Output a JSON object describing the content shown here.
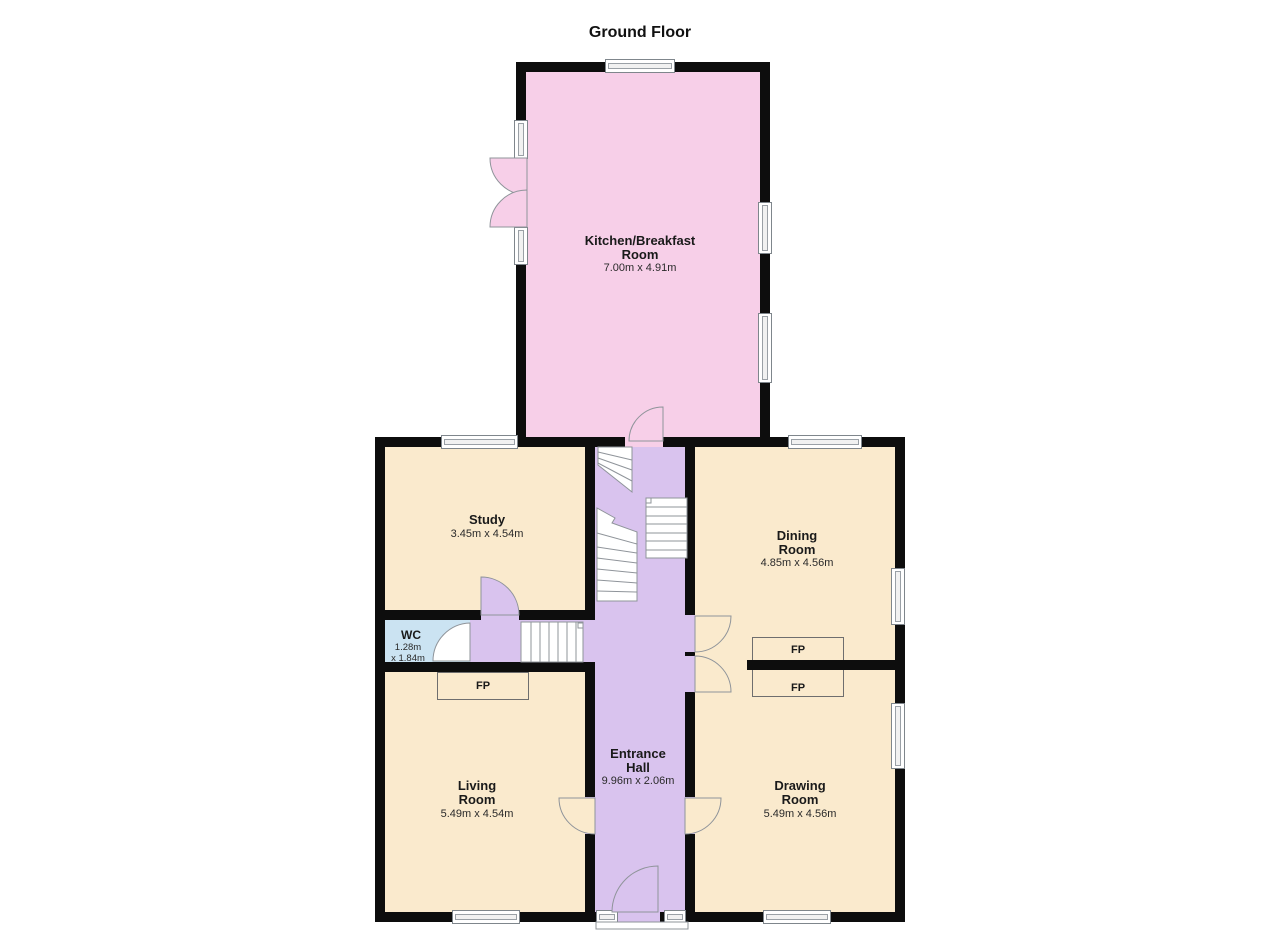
{
  "title": "Ground Floor",
  "rooms": {
    "kitchen": {
      "name": "Kitchen/Breakfast\nRoom",
      "dims": "7.00m x 4.91m"
    },
    "study": {
      "name": "Study",
      "dims": "3.45m x 4.54m"
    },
    "dining": {
      "name": "Dining\nRoom",
      "dims": "4.85m x 4.56m"
    },
    "wc": {
      "name": "WC",
      "dims": "1.28m\nx 1.84m"
    },
    "living": {
      "name": "Living\nRoom",
      "dims": "5.49m x 4.54m"
    },
    "hall": {
      "name": "Entrance\nHall",
      "dims": "9.96m x 2.06m"
    },
    "drawing": {
      "name": "Drawing\nRoom",
      "dims": "5.49m x 4.56m"
    }
  },
  "fireplaces": {
    "living": "FP",
    "dining": "FP",
    "drawing": "FP"
  },
  "colors": {
    "wall": "#0d0d0d",
    "kitchen_pink": "#F7CFE8",
    "room_cream": "#FAEACD",
    "hall_lavender": "#D9C3EE",
    "wc_blue": "#CBE3F2"
  }
}
